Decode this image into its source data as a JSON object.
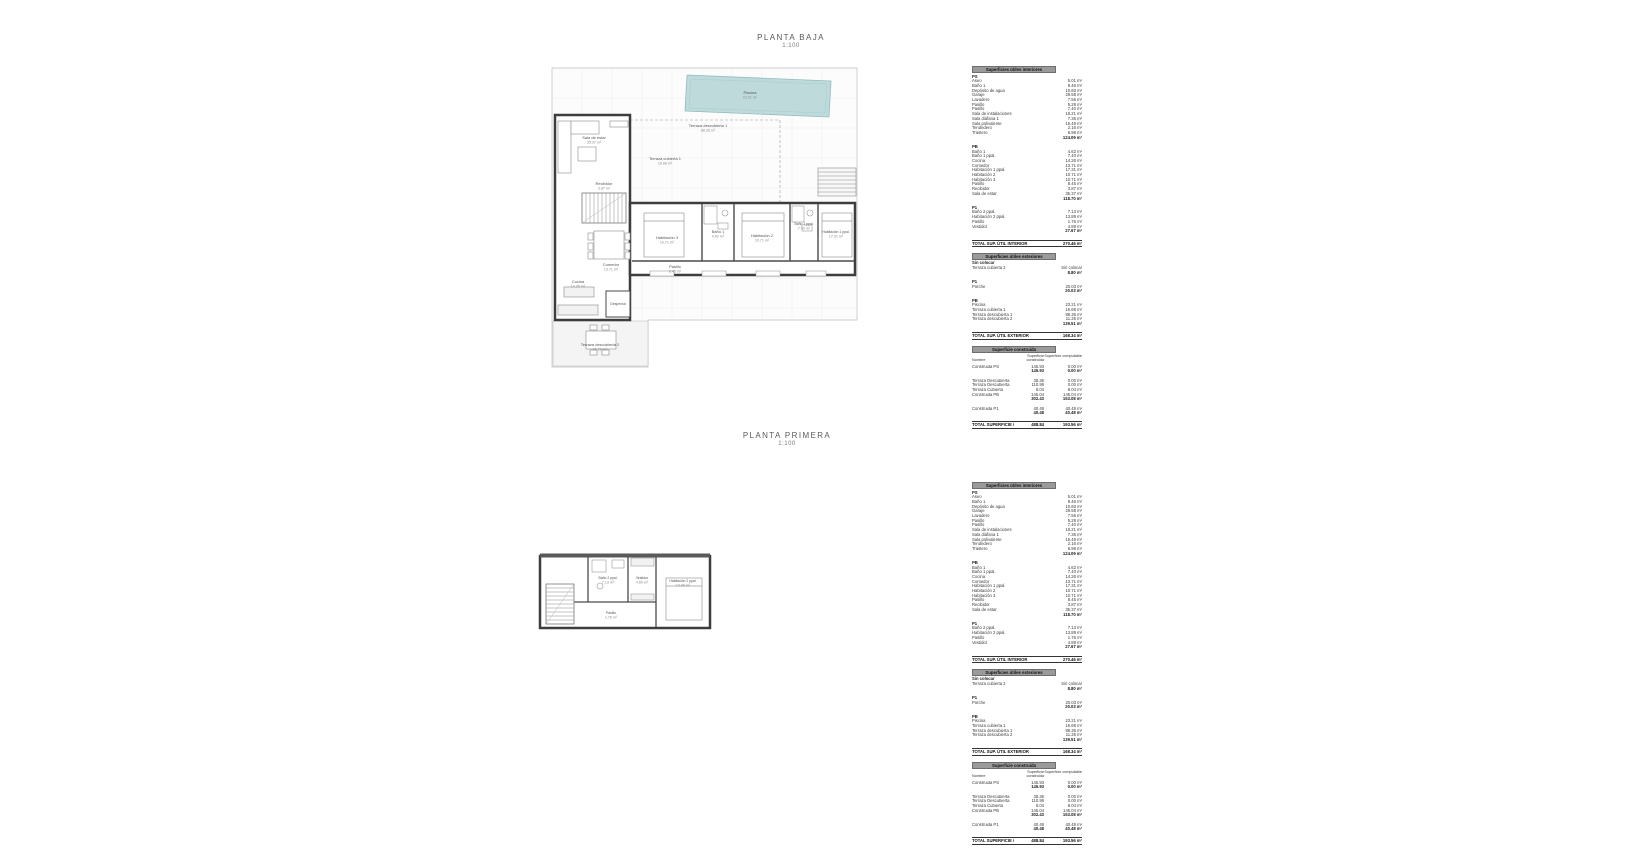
{
  "colors": {
    "pool_fill": "#bedadb",
    "pool_edge": "#93bcbe",
    "wall": "#3d3d3d",
    "table_header_bar": "#9a9a9a"
  },
  "sections": {
    "baja": {
      "title": "PLANTA BAJA",
      "scale": "1:100"
    },
    "primera": {
      "title": "PLANTA PRIMERA",
      "scale": "1:100"
    }
  },
  "plan_baja": {
    "rooms": [
      {
        "label": "Sala de estar",
        "area": "35.37 m²"
      },
      {
        "label": "Terraza descubierta 1",
        "area": "88.36 m²"
      },
      {
        "label": "Terraza cubierta 1",
        "area": "16.68 m²"
      },
      {
        "label": "Piscina",
        "area": "23.21 m²"
      },
      {
        "label": "Recibidor",
        "area": "3.87 m²"
      },
      {
        "label": "Comedor",
        "area": "13.71 m²"
      },
      {
        "label": "Cocina",
        "area": "14.26 m²"
      },
      {
        "label": "Despensa",
        "area": ""
      },
      {
        "label": "Habitación 3",
        "area": "10.71 m²"
      },
      {
        "label": "Baño 1",
        "area": "4.62 m²"
      },
      {
        "label": "Habitación 2",
        "area": "10.71 m²"
      },
      {
        "label": "Baño 1 ppal.",
        "area": "7.40 m²"
      },
      {
        "label": "Habitación 1 ppal.",
        "area": "17.31 m²"
      },
      {
        "label": "Pasillo",
        "area": "8.45 m²"
      },
      {
        "label": "Terraza descubierta 2",
        "area": "11.26 m²"
      }
    ]
  },
  "plan_primera": {
    "rooms": [
      {
        "label": "Baño 2 ppal.",
        "area": "7.13 m²"
      },
      {
        "label": "Vestidor",
        "area": "4.89 m²"
      },
      {
        "label": "Habitación 2 ppal.",
        "area": "13.89 m²"
      },
      {
        "label": "Pasillo",
        "area": "1.76 m²"
      }
    ]
  },
  "tables": {
    "interiores": {
      "title": "Superficies útiles interiores",
      "groups": [
        {
          "name": "PS",
          "rows": [
            [
              "Aseo",
              "5.01 m²"
            ],
            [
              "Baño 1",
              "8.46 m²"
            ],
            [
              "Depósito de agua",
              "10.60 m²"
            ],
            [
              "Garaje",
              "29.58 m²"
            ],
            [
              "Lavadero",
              "7.56 m²"
            ],
            [
              "Pasillo",
              "5.28 m²"
            ],
            [
              "Pasillo",
              "7.40 m²"
            ],
            [
              "Sala de instalaciones",
              "18.21 m²"
            ],
            [
              "Sala diáfana 1",
              "7.36 m²"
            ],
            [
              "Sala polivalente",
              "15.49 m²"
            ],
            [
              "Tendedero",
              "2.16 m²"
            ],
            [
              "Trastero",
              "6.98 m²"
            ]
          ],
          "subtotal": "124.09 m²"
        },
        {
          "name": "PB",
          "rows": [
            [
              "Baño 1",
              "4.62 m²"
            ],
            [
              "Baño 1 ppal.",
              "7.40 m²"
            ],
            [
              "Cocina",
              "14.26 m²"
            ],
            [
              "Comedor",
              "13.71 m²"
            ],
            [
              "Habitación 1 ppal.",
              "17.31 m²"
            ],
            [
              "Habitación 2",
              "10.71 m²"
            ],
            [
              "Habitación 3",
              "10.71 m²"
            ],
            [
              "Pasillo",
              "8.45 m²"
            ],
            [
              "Recibidor",
              "3.87 m²"
            ],
            [
              "Sala de estar",
              "35.37 m²"
            ]
          ],
          "subtotal": "118.70 m²"
        },
        {
          "name": "P1",
          "rows": [
            [
              "Baño 2 ppal.",
              "7.13 m²"
            ],
            [
              "Habitación 2 ppal.",
              "13.89 m²"
            ],
            [
              "Pasillo",
              "1.76 m²"
            ],
            [
              "Vestidor",
              "4.89 m²"
            ]
          ],
          "subtotal": "27.67 m²"
        }
      ],
      "total_label": "TOTAL SUP. ÚTIL INTERIOR",
      "total": "270.46 m²"
    },
    "exteriores": {
      "title": "Superficies útiles exteriores",
      "groups": [
        {
          "name": "Sin colocar",
          "rows": [
            [
              "Terraza cubierta 2",
              "Sin colocar"
            ]
          ],
          "subtotal": "8.80 m²"
        },
        {
          "name": "P1",
          "rows": [
            [
              "Porche",
              "20.03 m²"
            ]
          ],
          "subtotal": "20.03 m²"
        },
        {
          "name": "PB",
          "rows": [
            [
              "Piscina",
              "23.21 m²"
            ],
            [
              "Terraza cubierta 1",
              "16.68 m²"
            ],
            [
              "Terraza descubierta 1",
              "88.36 m²"
            ],
            [
              "Terraza descubierta 2",
              "11.26 m²"
            ]
          ],
          "subtotal": "139.51 m²"
        }
      ],
      "total_label": "TOTAL SUP. ÚTIL EXTERIOR",
      "total": "168.34 m²"
    },
    "construida": {
      "title": "Superficie construida",
      "col_headers": [
        "Nombre",
        "Superficie construida",
        "Superficie computable"
      ],
      "groups": [
        {
          "rows": [
            [
              "Construida PS",
              "145.93",
              "0.00 m²"
            ]
          ],
          "subtotal": [
            "145.93",
            "0.00 m²"
          ]
        },
        {
          "rows": [
            [
              "Terraza Descubierta",
              "38.36",
              "0.00 m²"
            ],
            [
              "Terraza Descubierta",
              "110.99",
              "0.00 m²"
            ],
            [
              "Terraza Cubierta",
              "8.04",
              "8.04 m²"
            ],
            [
              "Construida PB",
              "145.04",
              "145.04 m²"
            ]
          ],
          "subtotal": [
            "302.43",
            "153.08 m²"
          ]
        },
        {
          "rows": [
            [
              "Construida P1",
              "40.48",
              "40.48 m²"
            ]
          ],
          "subtotal": [
            "40.48",
            "40.48 m²"
          ]
        }
      ],
      "total_label": "TOTAL SUPERFICIE CONSTRUIDA:",
      "total": [
        "488.84",
        "193.56 m²"
      ]
    }
  }
}
